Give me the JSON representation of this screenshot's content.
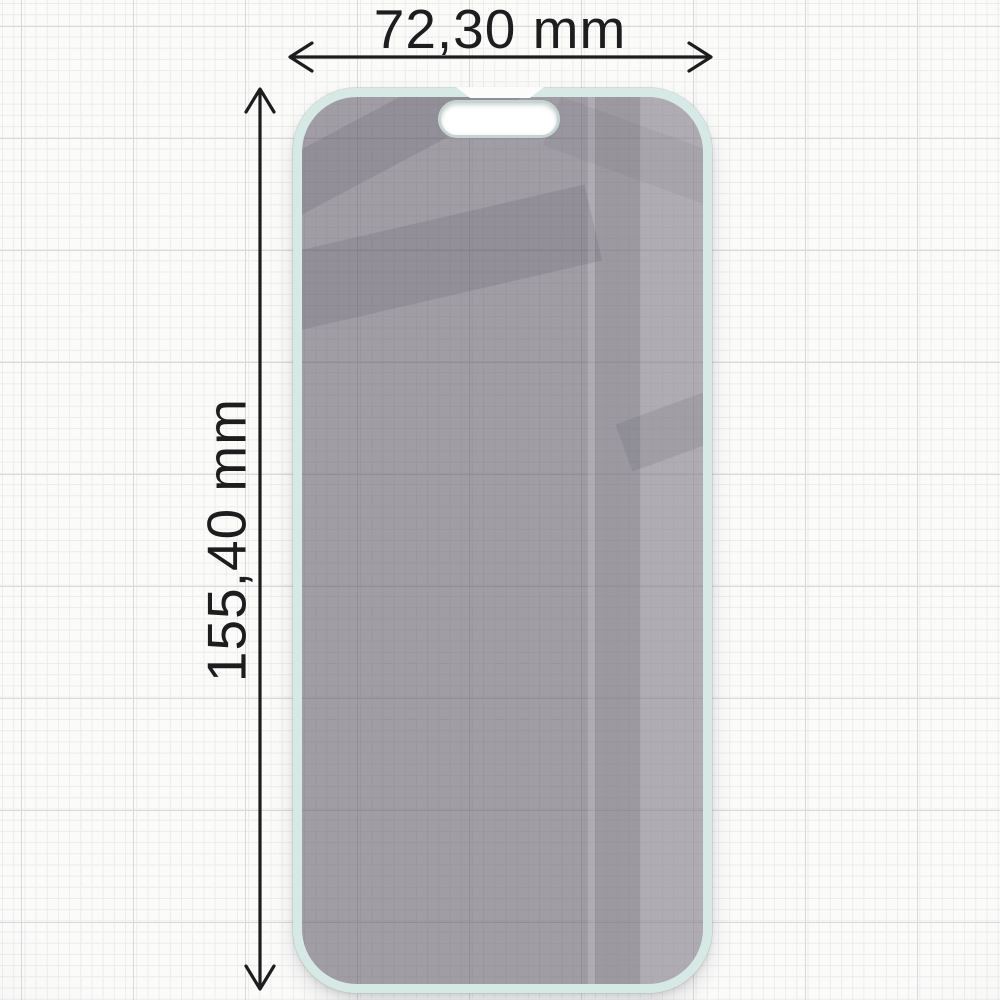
{
  "page": {
    "type": "product-dimension-diagram",
    "subject": "privacy tempered glass screen protector on graph paper"
  },
  "dimensions": {
    "width_label": "72,30 mm",
    "height_label": "155,40 mm"
  },
  "icons": {
    "horizontal_arrow": "double-headed-horizontal-dimension-arrow",
    "vertical_arrow": "double-headed-vertical-dimension-arrow"
  },
  "colors": {
    "paper": "#fbfbfa",
    "grid_minor": "#ececec",
    "grid_major": "#d9d9db",
    "dimension_line": "#1d1d1f",
    "label_text": "#1d1d1f",
    "glass_edge_mint": "#d7e9e5",
    "glass_tint": "#a3a0a8",
    "glass_dark_band": "#9b98a0",
    "glass_highlight": "#b2afb6",
    "cutout_fill": "#ffffff"
  }
}
